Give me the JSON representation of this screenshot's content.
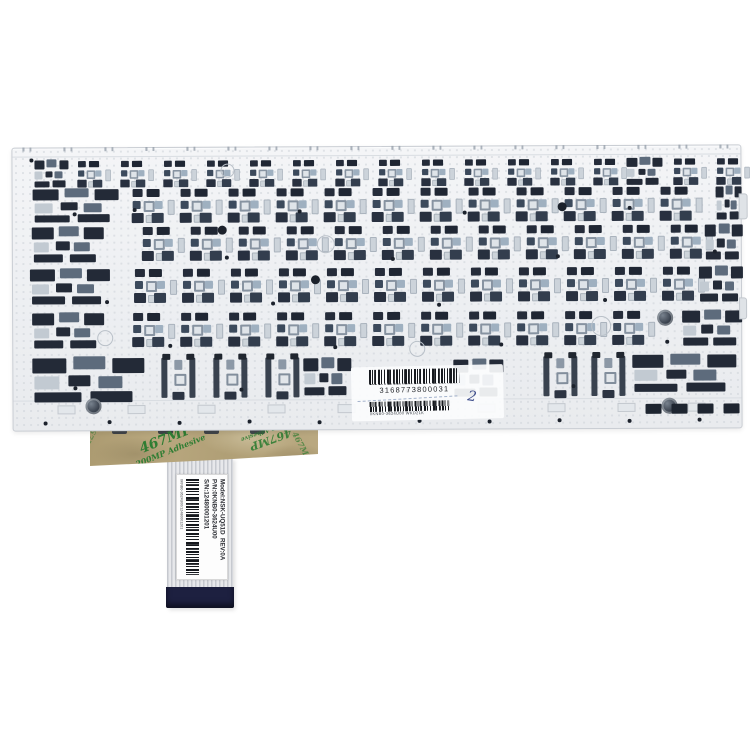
{
  "product": {
    "description": "laptop keyboard backplate with ribbon cable, rear view product photo"
  },
  "plate": {
    "main_barcode_number": "3168773800031",
    "secondary_barcode_text": "0KNB0-3624U00 WKD21K",
    "handwritten_mark": "2"
  },
  "tape": {
    "line1": "467MP",
    "line2": "200MP Adhesive"
  },
  "ribbon_label": {
    "model_line": "Model:NSK-UQ51D  REV:0A",
    "pn_line": "P/N:0KNB0-3624U00",
    "sn_line": "S/N:12480001201",
    "barcode_text": "0KNB0-3624U00/12480001201"
  },
  "colors": {
    "background": "#ffffff",
    "plate": "#eff1f3",
    "mechanism_dark": "#232a37",
    "mechanism_mid": "#5d6b7c",
    "tape": "#b2a176",
    "tape_print_green": "#2f7d33",
    "stiffener_navy": "#1d2040",
    "handwriting_blue": "#3f4e8c",
    "barcode_black": "#15181d"
  }
}
